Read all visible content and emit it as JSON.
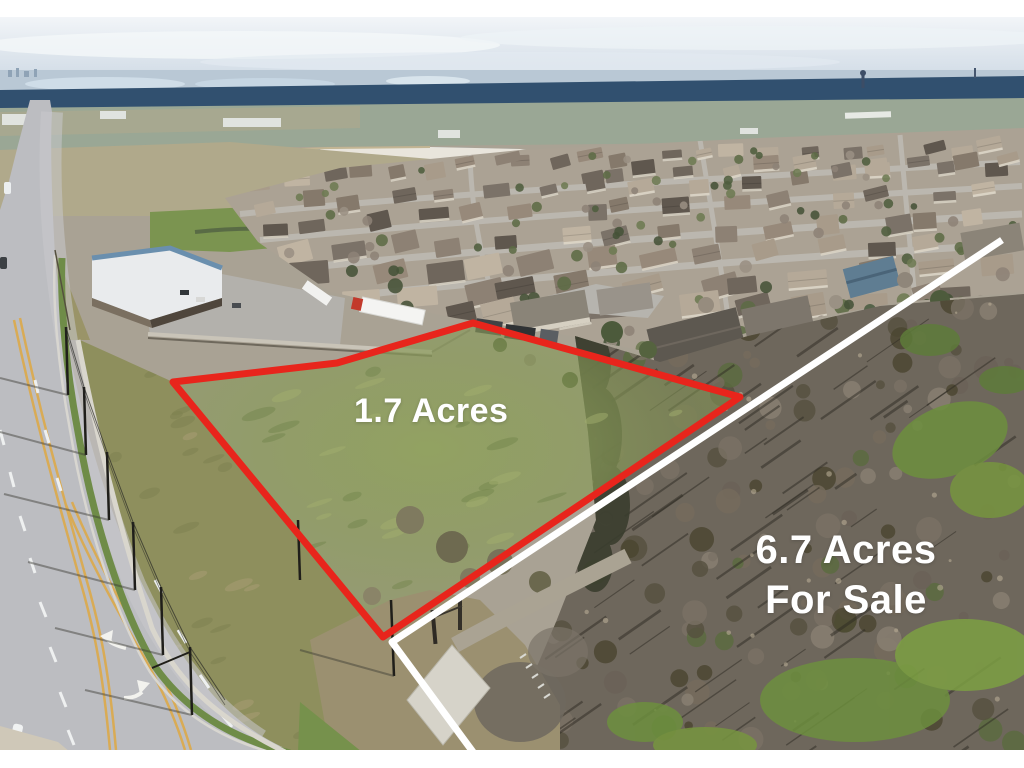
{
  "annotations": {
    "small_parcel": {
      "label": "1.7 Acres",
      "outline_color": "#e8251c"
    },
    "large_parcel": {
      "line1": "6.7 Acres",
      "line2": "For Sale",
      "boundary_color": "#ffffff"
    }
  }
}
